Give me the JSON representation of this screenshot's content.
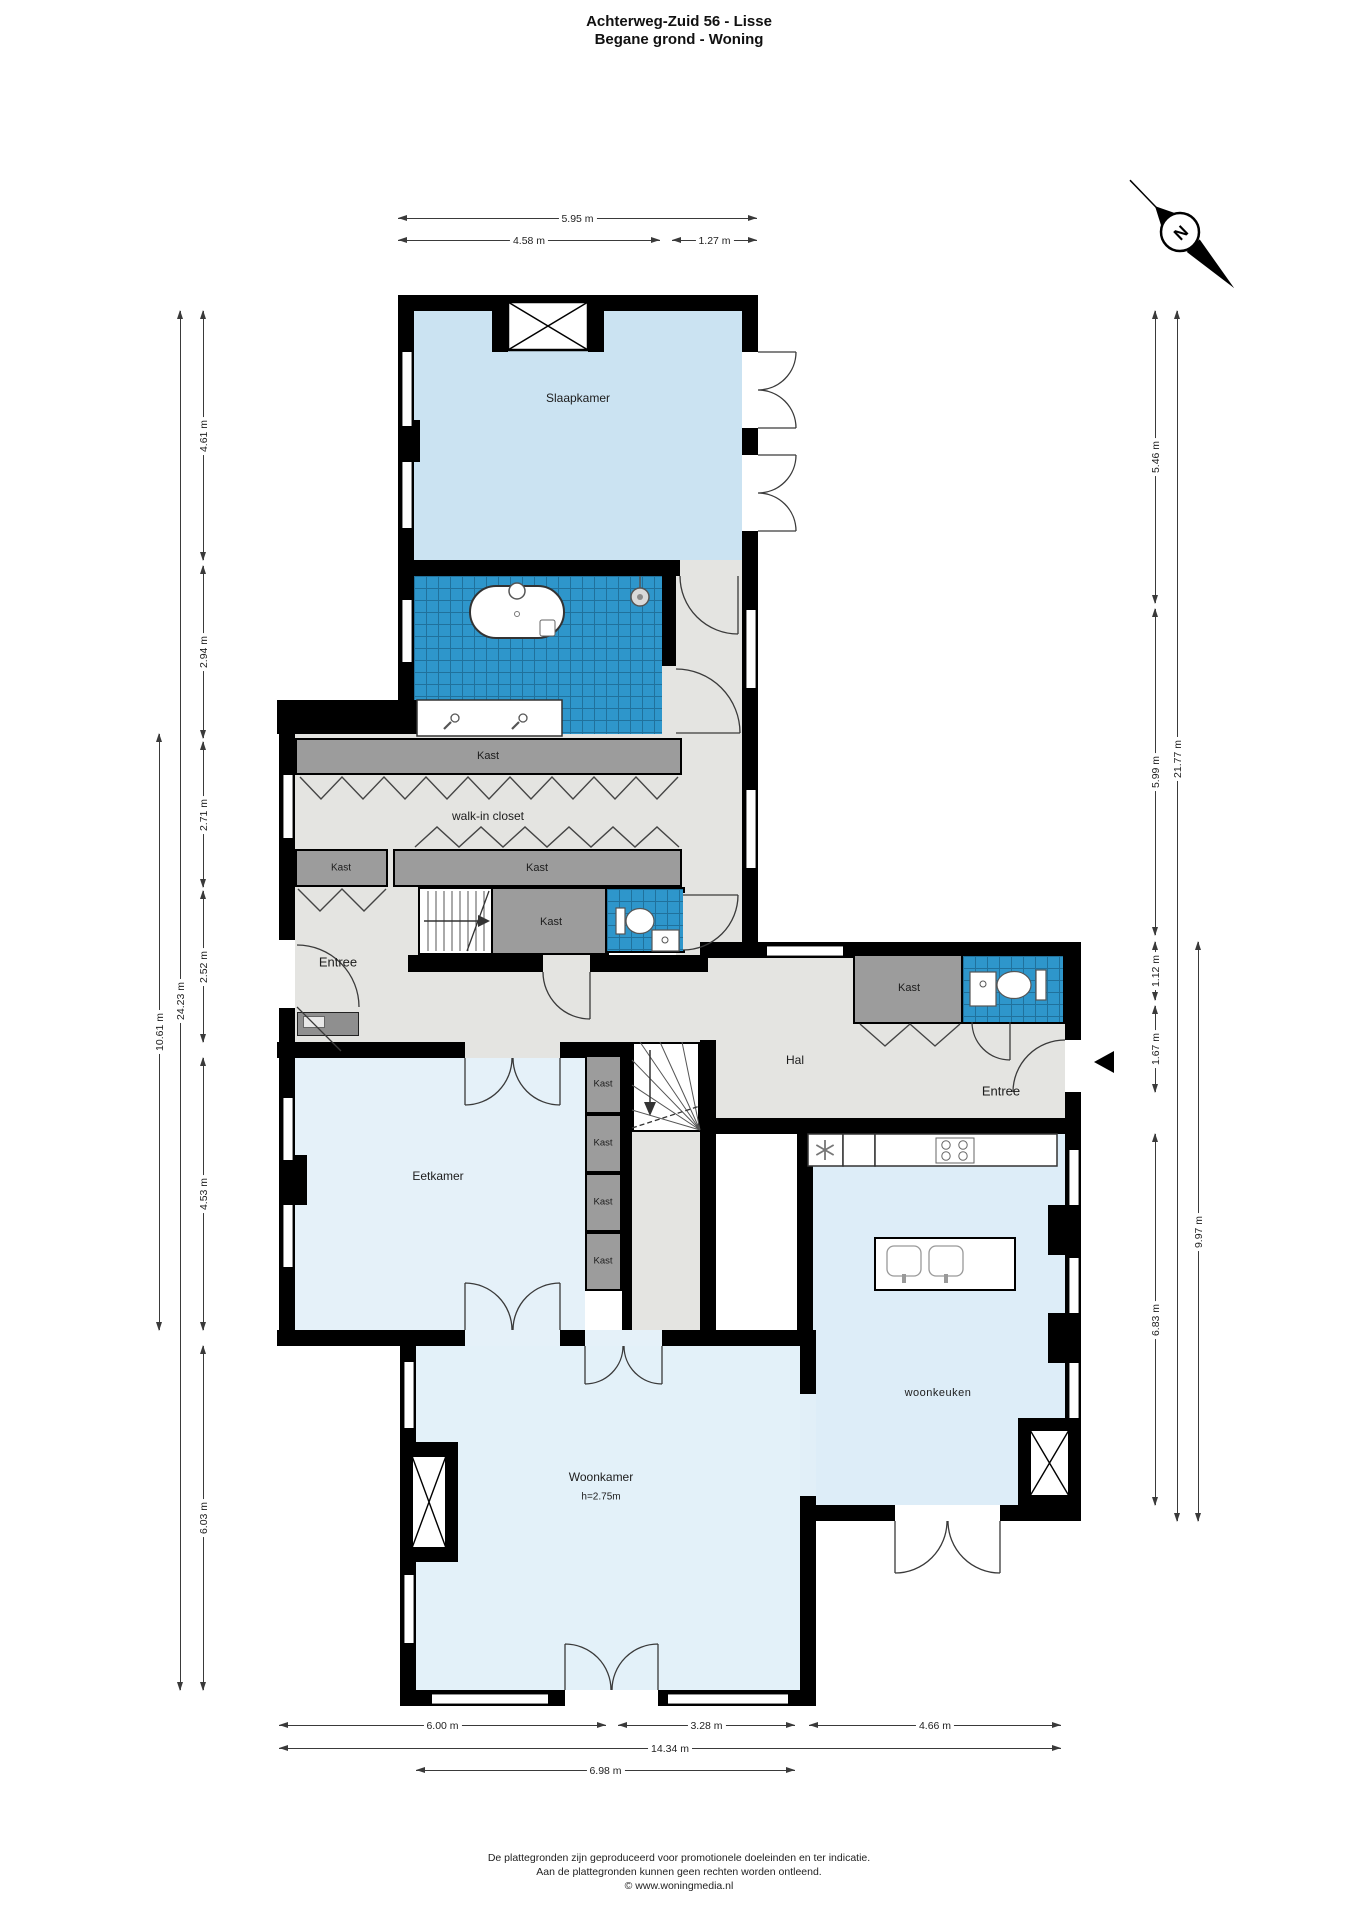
{
  "header": {
    "title": "Achterweg-Zuid 56 - Lisse",
    "subtitle": "Begane grond - Woning"
  },
  "compass": {
    "north_label": "N"
  },
  "rooms": {
    "slaapkamer": "Slaapkamer",
    "kast_bathroom": "Kast",
    "walk_in_closet": "walk-in closet",
    "kast_small": "Kast",
    "kast_long": "Kast",
    "kast_stairs": "Kast",
    "entree_left": "Entree",
    "hal": "Hal",
    "kast_hal": "Kast",
    "entree_right": "Entree",
    "eetkamer": "Eetkamer",
    "kast_column": [
      "Kast",
      "Kast",
      "Kast",
      "Kast"
    ],
    "woonkeuken": "woonkeuken",
    "woonkamer": "Woonkamer",
    "woonkamer_ceiling_height": "h=2.75m"
  },
  "dimensions": {
    "top": [
      "5.95 m",
      "4.58 m",
      "1.27 m"
    ],
    "left": [
      "4.61 m",
      "2.94 m",
      "2.71 m",
      "2.52 m",
      "4.53 m",
      "6.03 m",
      "24.23 m",
      "10.61 m"
    ],
    "right": [
      "5.46 m",
      "5.99 m",
      "1.12 m",
      "1.67 m",
      "6.83 m",
      "21.77 m",
      "9.97 m"
    ],
    "bottom": [
      "6.00 m",
      "3.28 m",
      "4.66 m",
      "14.34 m",
      "6.98 m"
    ]
  },
  "footer": {
    "line1": "De plattegronden zijn geproduceerd voor promotionele doeleinden en ter indicatie.",
    "line2": "Aan de plattegronden kunnen geen rechten worden ontleend.",
    "line3": "© www.woningmedia.nl"
  },
  "colors": {
    "wall_black": "#000000",
    "bedroom_blue": "#cbe3f2",
    "room_blue_light": "#e5f1f9",
    "kitchen_blue": "#ddedf8",
    "tile_blue": "#2e96cb",
    "closet_gray": "#9c9c9c",
    "floor_gray": "#e4e4e1"
  }
}
